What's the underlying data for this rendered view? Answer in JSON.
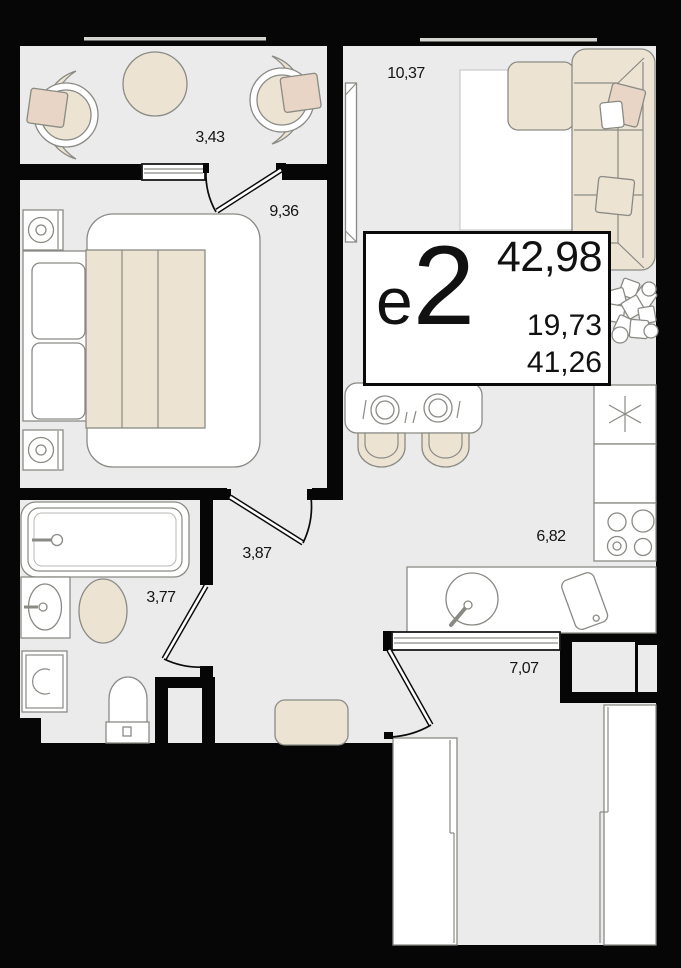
{
  "plan": {
    "unit": {
      "type_letter": "е",
      "type_digit": "2",
      "type_label": "е2",
      "total_area": "42,98",
      "living_area": "19,73",
      "secondary_area": "41,26"
    },
    "rooms": [
      {
        "name": "loggia",
        "area": "3,43"
      },
      {
        "name": "bedroom",
        "area": "9,36"
      },
      {
        "name": "living-room",
        "area": "10,37"
      },
      {
        "name": "kitchen",
        "area": "6,82"
      },
      {
        "name": "bathroom",
        "area": "3,77"
      },
      {
        "name": "hallway",
        "area": "3,87"
      },
      {
        "name": "corridor",
        "area": "7,07"
      }
    ],
    "colors": {
      "wall": "#060606",
      "floor": "#ebebeb",
      "furniture": "#ece3d3",
      "pillow": "#e8d5c5",
      "outline": "#8a8a85"
    }
  }
}
